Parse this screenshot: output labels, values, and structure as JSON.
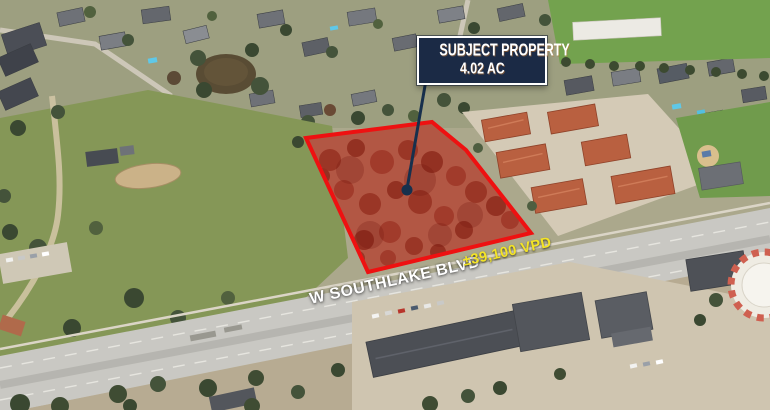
{
  "colors": {
    "outline-red": "#ee1111",
    "overlay-red": "rgba(200,35,22,0.5)",
    "navy": "#1b2a45",
    "leader": "#17304d",
    "white": "#ffffff",
    "traffic-yellow": "#f4e426"
  },
  "annotation": {
    "title": "SUBJECT PROPERTY",
    "acreage": "4.02 AC"
  },
  "road": {
    "name": "W SOUTHLAKE BLVD",
    "traffic": "±39,100 VPD"
  }
}
